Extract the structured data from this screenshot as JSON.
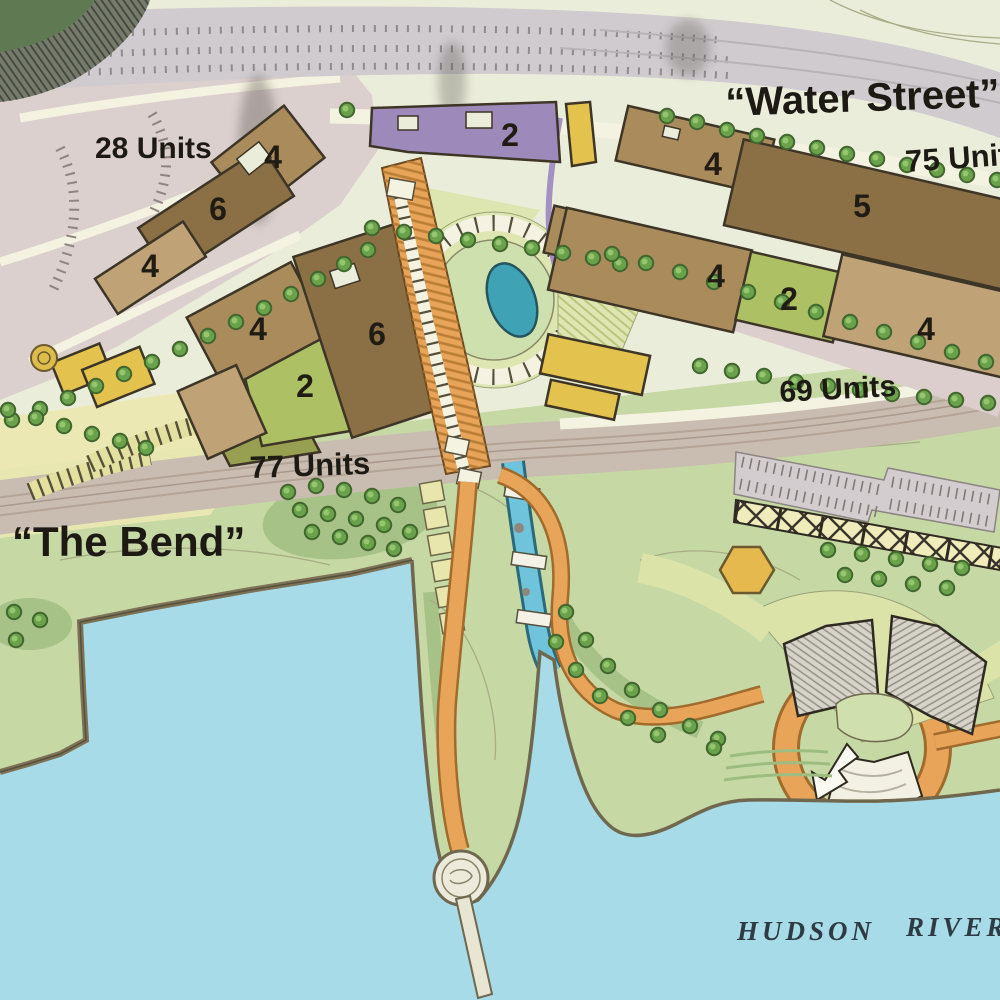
{
  "labels": {
    "water_street": "“Water Street”",
    "units_75": "75 Units",
    "units_28": "28 Units",
    "units_69": "69 Units",
    "units_77": "77 Units",
    "the_bend": "“The Bend”",
    "hudson": "HUDSON",
    "river": "RIVER"
  },
  "buildings": {
    "purple": "2",
    "nw_a": "4",
    "nw_b": "6",
    "nw_c": "4",
    "ne_a": "4",
    "ne_b": "5",
    "ne_c": "4",
    "ne_green": "2",
    "ne_d": "4",
    "center_a": "4",
    "center_b": "6",
    "center_green": "2"
  },
  "colors": {
    "water": "#a7dbe8",
    "land": "#ebeddb",
    "park": "#c6d8a4",
    "parkDark": "#a6c287",
    "tree": "#6aa24c",
    "treeDark": "#41672f",
    "treeLight": "#9ccb76",
    "roadMauve": "#dbcecd",
    "roadTan": "#c9bcb1",
    "highway": "#cfcbce",
    "cream": "#f4f2e0",
    "brownDark": "#8c7045",
    "brownMid": "#aa8b5c",
    "brownLight": "#bfa377",
    "purple": "#9e8aba",
    "yellow": "#e3c24e",
    "paleYellow": "#ebe8b2",
    "olive": "#97a050",
    "greenParcel": "#adc063",
    "orange": "#e8a458",
    "orangeDark": "#a06b2c",
    "teal": "#3fa3b5"
  }
}
